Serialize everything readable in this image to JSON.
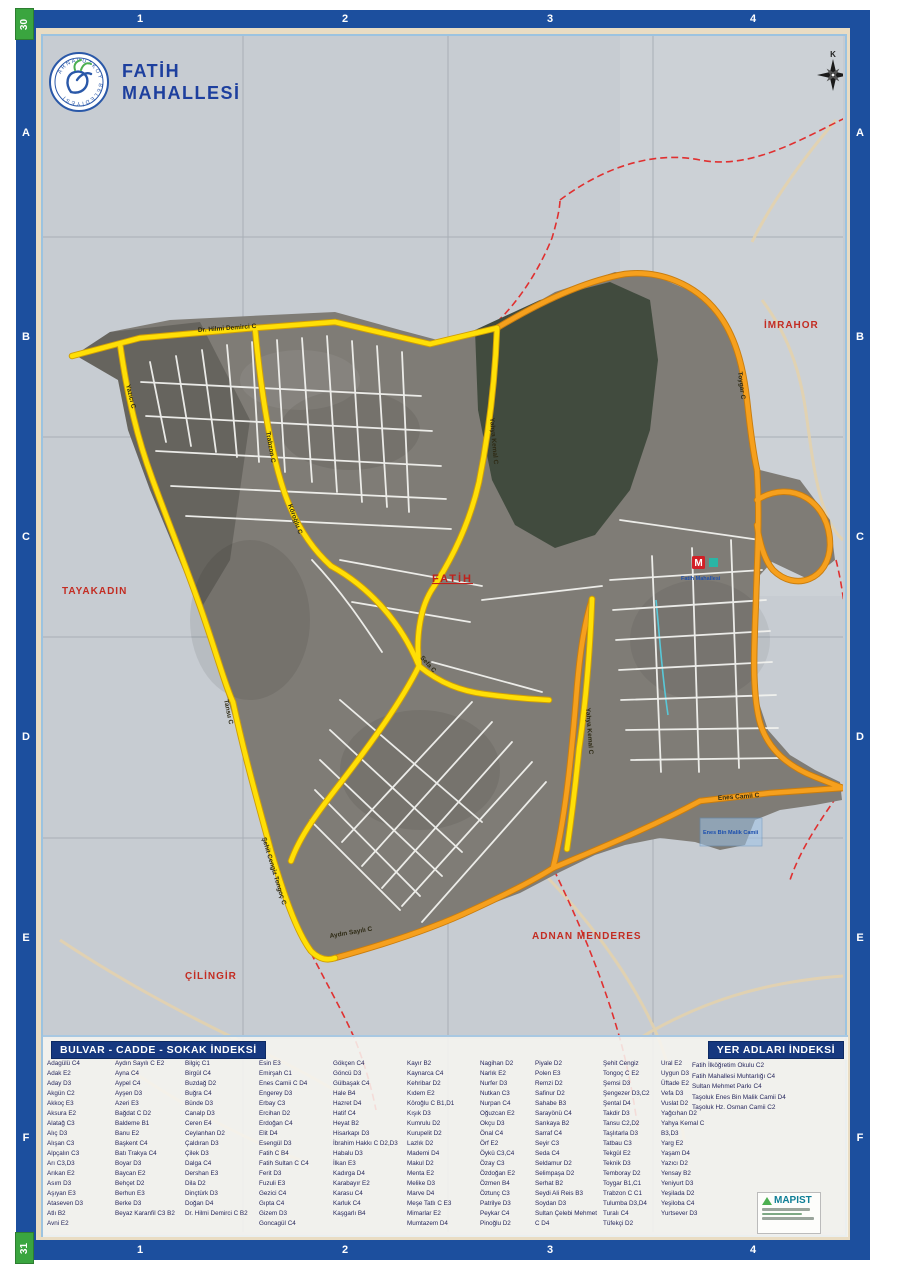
{
  "page": {
    "tab_top": "30",
    "tab_bottom": "31"
  },
  "header": {
    "municipality": "ARNAVUTKÖY BELEDİYESİ",
    "title_line1": "FATİH",
    "title_line2": "MAHALLESİ"
  },
  "grid": {
    "cols": [
      "1",
      "2",
      "3",
      "4"
    ],
    "rows": [
      "A",
      "B",
      "C",
      "D",
      "E",
      "F"
    ]
  },
  "map": {
    "compass_label": "K",
    "area_labels": {
      "tayakadin": "TAYAKADIN",
      "imrahor": "İMRAHOR",
      "cilingir": "ÇİLİNGİR",
      "adnan_menderes": "ADNAN MENDERES",
      "fatih": "FATİH"
    },
    "road_labels": {
      "dr_hilmi": "Dr. Hilmi Demirci C",
      "yazici": "Yazıcı C",
      "trabzon": "Trabzon C",
      "koroglu": "Köroğlu C",
      "yahya_kemal_1": "Yahya Kemal C",
      "sefa": "Sefa C",
      "yahya_kemal_2": "Yahya Kemal C",
      "enes_camii": "Enes Camii C",
      "sehit_cengiz": "Şehit Cengiz Tongoç C",
      "aydin_sayili": "Aydın Sayılı C",
      "toygar": "Toygar C",
      "tansu": "Tansu C"
    },
    "metro": {
      "symbol": "M",
      "station": "Fatih Mahallesi"
    },
    "poi": {
      "mosque": "Enes Bin Malik Camii"
    }
  },
  "street_index": {
    "title": "BULVAR - CADDE - SOKAK İNDEKSİ",
    "columns": [
      [
        "Adagülü C4",
        "Adak E2",
        "Aday D3",
        "Akgün C2",
        "Akkoç E3",
        "Aksura E2",
        "Alatağ C3",
        "Alıç D3",
        "Alışan C3",
        "Alpçalın C3",
        "Arı C3,D3",
        "Arıkan E2",
        "Asım D3",
        "Aşıyan E3",
        "Ataseven D3",
        "Atlı B2",
        "Avni E2"
      ],
      [
        "Aydın Sayılı C E2",
        "Ayna C4",
        "Aypel C4",
        "Ayşen D3",
        "Azeri E3",
        "Bağdat C D2",
        "Baldeme B1",
        "Banu E2",
        "Başkent C4",
        "Batı Trakya C4",
        "Boyar D3",
        "Baycan E2",
        "Behçet D2",
        "Berhun E3",
        "Berke D3",
        "Beyaz Karanfil C3 B2"
      ],
      [
        "Bilgiç C1",
        "Birgül C4",
        "Buzdağ D2",
        "Buğra C4",
        "Bünde D3",
        "Canalp D3",
        "Ceren E4",
        "Ceylanhan D2",
        "Çaldıran D3",
        "Çilek D3",
        "Dalga C4",
        "Dershan E3",
        "Dila D2",
        "Dinçtürk D3",
        "Doğan D4",
        "Dr. Hilmi Demirci C B2"
      ],
      [
        "Esin E3",
        "Emirşah C1",
        "Enes Camii C D4",
        "Engerey D3",
        "Erbay C3",
        "Ercihan D2",
        "Erdoğan C4",
        "Elit D4",
        "Esengül D3",
        "Fatih C B4",
        "Fatih Sultan C C4",
        "Ferit D3",
        "Fuzuli E3",
        "Gezici C4",
        "Gıpta C4",
        "Gizem D3",
        "Goncagül C4"
      ],
      [
        "Gökçen C4",
        "Göncü D3",
        "Gülbaşak C4",
        "Hale B4",
        "Hazret D4",
        "Hatif C4",
        "Heyat B2",
        "Hisarkapı D3",
        "İbrahim Hakkı C D2,D3",
        "Habalu D3",
        "İlkan E3",
        "Kadırga D4",
        "Karabayır E2",
        "Karasu C4",
        "Karluk C4",
        "Kaşgarlı B4"
      ],
      [
        "Kayır B2",
        "Kaynarca C4",
        "Kehribar D2",
        "Kıdem E2",
        "Köroğlu C B1,D1",
        "Kışık D3",
        "Kumrulu D2",
        "Kurupelit D2",
        "Lazlık D2",
        "Mademi D4",
        "Makul D2",
        "Menta E2",
        "Melike D3",
        "Marve D4",
        "Meşe Tatlı C E3",
        "Mimarlar E2",
        "Mumtazem D4"
      ],
      [
        "Nagihan D2",
        "Narlık E2",
        "Nurfer D3",
        "Nutkan C3",
        "Nurpan C4",
        "Oğuzcan E2",
        "Okçu D3",
        "Önal C4",
        "Örf E2",
        "Öykü C3,C4",
        "Özay C3",
        "Özdoğan E2",
        "Özmen B4",
        "Öztunç C3",
        "Patrilye D3",
        "Peykar C4",
        "Pinoğlu D2"
      ],
      [
        "Piyale D2",
        "Polen E3",
        "Remzi D2",
        "Safinur D2",
        "Sahabe B3",
        "Sarayönü C4",
        "Sarıkaya B2",
        "Sarraf C4",
        "Seyir C3",
        "Seda C4",
        "Seldamur D2",
        "Selimpaşa D2",
        "Serhat B2",
        "Seydi Ali Reis B3",
        "Soydan D3",
        "Sultan Çelebi Mehmet C D4"
      ],
      [
        "Şehit Cengiz Tongoç C E2",
        "Şemsi D3",
        "Şengezer D3,C2",
        "Şental D4",
        "Takdir D3",
        "Tansu C2,D2",
        "Taşlıtarla D3",
        "Tatbau C3",
        "Tekgül E2",
        "Teknik D3",
        "Temboray D2",
        "Toygar B1,C1",
        "Trabzon C C1",
        "Tulumba D3,D4",
        "Turalı C4",
        "Tüfekçi D2"
      ],
      [
        "Ural E2",
        "Uygun D3",
        "Üftade E2",
        "Vefa D3",
        "Vuslat D2",
        "Yağcıhan D2",
        "Yahya Kemal C B3,D3",
        "Yarg E2",
        "Yaşam D4",
        "Yazıcı D2",
        "Yensay B2",
        "Yeniyurt D3",
        "Yeşilada D2",
        "Yeşiloba C4",
        "Yurtsever D3"
      ]
    ]
  },
  "place_index": {
    "title": "YER ADLARI İNDEKSİ",
    "entries": [
      "Fatih İlköğretim Okulu C2",
      "Fatih Mahallesi Muhtarlığı C4",
      "Sultan Mehmet Parkı C4",
      "Taşoluk Enes Bin Malik Camii D4",
      "Taşoluk Hz. Osman Camii C2"
    ]
  },
  "credits": {
    "brand": "MAPIST"
  }
}
